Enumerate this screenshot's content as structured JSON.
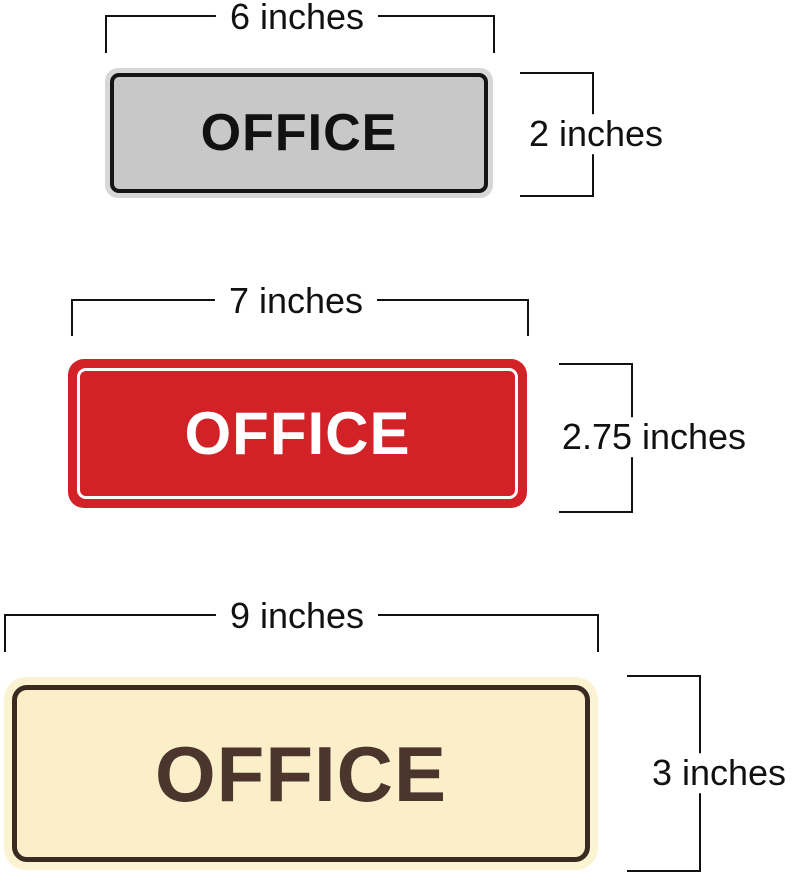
{
  "page": {
    "background": "#ffffff",
    "annotation_color": "#111111"
  },
  "signs": [
    {
      "text": "OFFICE",
      "width_label": "6 inches",
      "height_label": "2 inches",
      "rim_color": "#d7d7d7",
      "face_color": "#c8c8c8",
      "border_color": "#151515",
      "text_color": "#111111"
    },
    {
      "text": "OFFICE",
      "width_label": "7 inches",
      "height_label": "2.75 inches",
      "face_color": "#d32128",
      "border_color": "#ffffff",
      "text_color": "#ffffff"
    },
    {
      "text": "OFFICE",
      "width_label": "9 inches",
      "height_label": "3 inches",
      "halo_color": "#fcf3d3",
      "face_color": "#faefc9",
      "border_color": "#3a2a20",
      "text_color": "#4b352c"
    }
  ]
}
